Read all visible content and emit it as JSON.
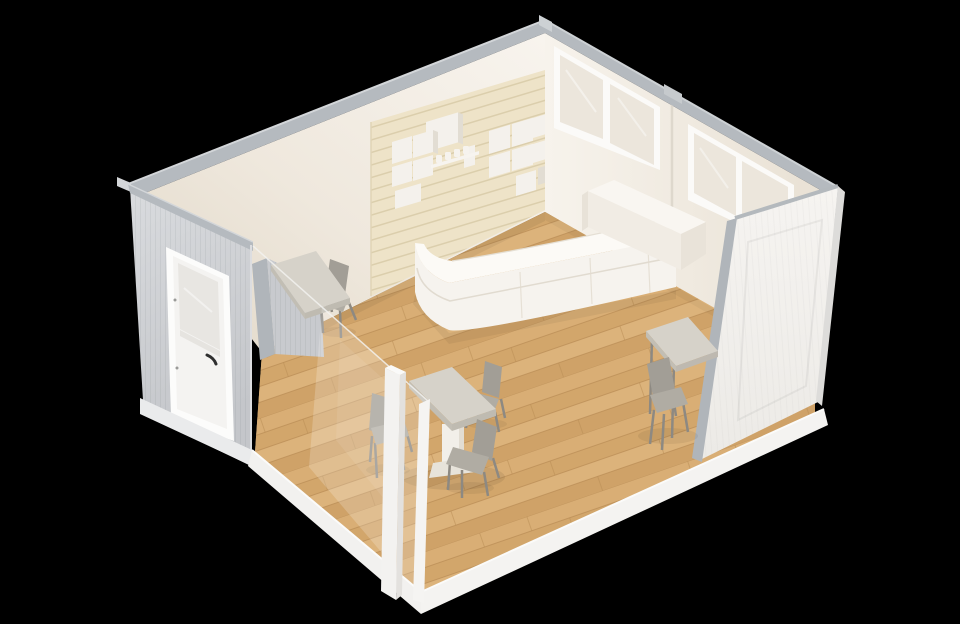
{
  "scene": {
    "description": "Isometric cutaway 3D rendering of a small modular cafe interior: curved white reception counter, wood slat feature wall with white box shelves and cups, clerestory windows, gray corrugated exterior wall with glazed white door, glass storefront, wood plank floor, cafe tables with gray chairs, and a white cutaway front wall, on a black background.",
    "objects": {
      "building": "modular-cafe-cutaway",
      "furniture": [
        "reception-counter",
        "center-pedestal-table",
        "wall-ledge-table",
        "right-wall-table",
        "gray-cafe-chairs"
      ],
      "architecture": [
        "back-left-wall",
        "back-right-wall",
        "left-exterior-wall-with-door",
        "glass-storefront",
        "front-right-cutaway-wall",
        "wood-plank-floor",
        "clerestory-windows",
        "slat-feature-wall",
        "box-shelves",
        "cups"
      ]
    }
  },
  "colors": {
    "background": "#000000",
    "trim": "#b5babf",
    "trim_light": "#d0d4d7",
    "cut_trim": "#b0b5ba",
    "wall_cream": "#f1ebe1",
    "slat_panel": "#eee3c8",
    "slat_line": "#dbceac",
    "gray_wall": "#cfd1d5",
    "leaning_wall": "#f3f1ee",
    "leaning_wall_edge": "#dddcda",
    "window_frame": "#fbfaf8",
    "window_glass": "#ece6dc",
    "door_frame": "#fcfcfb",
    "door_panel": "#f4f3f1",
    "door_glass": "#e8e6e2",
    "door_handle": "#2f2f2f",
    "floor_wood": "#d5aa70",
    "counter_front": "#f6f3ee",
    "counter_top": "#fcfaf6",
    "counter_groove": "#ddd6ca",
    "counter_raised_front": "#f1ece4",
    "counter_raised_top": "#f9f6f1",
    "counter_raised_side": "#e9e3d9",
    "table_top": "#d6d2c9",
    "table_edge": "#c2beb4",
    "pedestal": "#f2efe9",
    "pedestal_base": "#e7e3da",
    "chair": "#a29e96",
    "chair_light": "#b0aca3",
    "chair_leg": "#8d8982",
    "box_front": "#f4f1ec",
    "box_side": "#e2ddd3",
    "shelf_strip": "#f7f4ef",
    "base_frame": "#f2f1ef",
    "base_lip": "#fbfbfa",
    "post": "#f3f2f0",
    "post_side": "#e3e1de"
  }
}
